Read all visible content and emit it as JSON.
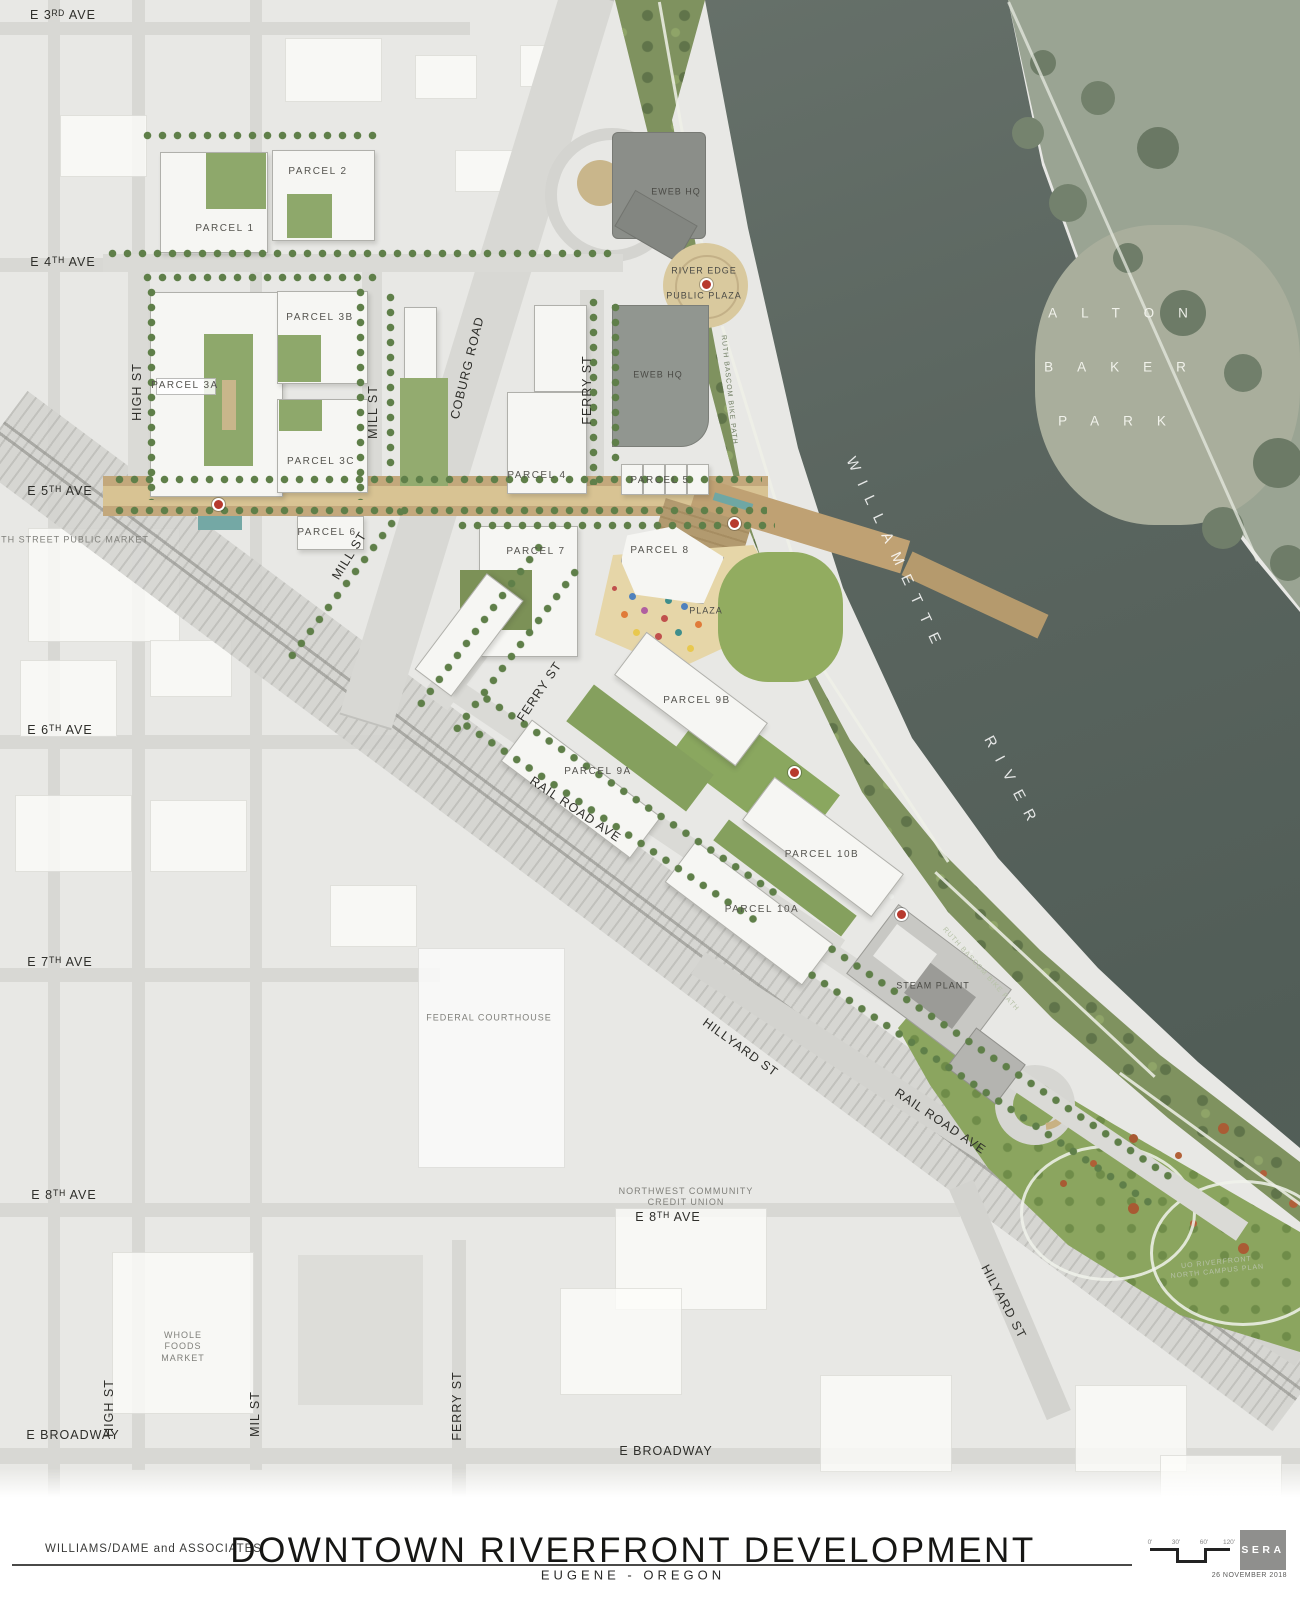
{
  "title_block": {
    "client": "WILLIAMS/DAME and ASSOCIATES",
    "title": "DOWNTOWN RIVERFRONT DEVELOPMENT",
    "subtitle": "EUGENE - OREGON",
    "firm_logo": "SERA",
    "date": "26 NOVEMBER 2018",
    "scale_ticks": [
      "0'",
      "30'",
      "60'",
      "120'"
    ]
  },
  "map": {
    "street_labels": [
      {
        "t": "E 3ᴿᴰ AVE",
        "x": 63,
        "y": 16,
        "r": 0
      },
      {
        "t": "E 4ᵀᴴ AVE",
        "x": 63,
        "y": 263,
        "r": 0
      },
      {
        "t": "E 5ᵀᴴ AVE",
        "x": 60,
        "y": 492,
        "r": 0
      },
      {
        "t": "E 6ᵀᴴ AVE",
        "x": 60,
        "y": 731,
        "r": 0
      },
      {
        "t": "E 7ᵀᴴ AVE",
        "x": 60,
        "y": 963,
        "r": 0
      },
      {
        "t": "E 8ᵀᴴ AVE",
        "x": 64,
        "y": 1196,
        "r": 0
      },
      {
        "t": "E 8ᵀᴴ AVE",
        "x": 668,
        "y": 1218,
        "r": 0
      },
      {
        "t": "E BROADWAY",
        "x": 73,
        "y": 1436,
        "r": 0
      },
      {
        "t": "E BROADWAY",
        "x": 666,
        "y": 1452,
        "r": 0
      },
      {
        "t": "HIGH ST",
        "x": 138,
        "y": 392,
        "r": -90
      },
      {
        "t": "HIGH ST",
        "x": 110,
        "y": 1408,
        "r": -90
      },
      {
        "t": "MILL ST",
        "x": 374,
        "y": 412,
        "r": -90
      },
      {
        "t": "MILL ST",
        "x": 350,
        "y": 556,
        "r": -58
      },
      {
        "t": "MIL ST",
        "x": 256,
        "y": 1414,
        "r": -90
      },
      {
        "t": "COBURG ROAD",
        "x": 468,
        "y": 368,
        "r": -76
      },
      {
        "t": "FERRY ST",
        "x": 588,
        "y": 390,
        "r": -90
      },
      {
        "t": "FERRY ST",
        "x": 540,
        "y": 692,
        "r": -56
      },
      {
        "t": "FERRY ST",
        "x": 458,
        "y": 1406,
        "r": -90
      },
      {
        "t": "RAIL ROAD AVE",
        "x": 575,
        "y": 810,
        "r": 34
      },
      {
        "t": "RAIL ROAD AVE",
        "x": 940,
        "y": 1122,
        "r": 34
      },
      {
        "t": "HILLYARD ST",
        "x": 740,
        "y": 1048,
        "r": 36
      },
      {
        "t": "HILYARD ST",
        "x": 1003,
        "y": 1302,
        "r": 62
      }
    ],
    "parcel_labels": [
      {
        "t": "PARCEL 1",
        "x": 225,
        "y": 229,
        "r": 0
      },
      {
        "t": "PARCEL 2",
        "x": 318,
        "y": 172,
        "r": 0
      },
      {
        "t": "PARCEL 3A",
        "x": 185,
        "y": 386,
        "r": 0
      },
      {
        "t": "PARCEL 3B",
        "x": 320,
        "y": 318,
        "r": 0
      },
      {
        "t": "PARCEL 3C",
        "x": 321,
        "y": 462,
        "r": 0
      },
      {
        "t": "PARCEL 4",
        "x": 537,
        "y": 476,
        "r": 0
      },
      {
        "t": "PARCEL 5",
        "x": 660,
        "y": 481,
        "r": 0
      },
      {
        "t": "PARCEL 6",
        "x": 327,
        "y": 533,
        "r": 0
      },
      {
        "t": "PARCEL 7",
        "x": 536,
        "y": 552,
        "r": 0
      },
      {
        "t": "PARCEL 8",
        "x": 660,
        "y": 551,
        "r": 0
      },
      {
        "t": "PARCEL 9A",
        "x": 598,
        "y": 772,
        "r": 0
      },
      {
        "t": "PARCEL 9B",
        "x": 697,
        "y": 701,
        "r": 0
      },
      {
        "t": "PARCEL 10A",
        "x": 762,
        "y": 910,
        "r": 0
      },
      {
        "t": "PARCEL 10B",
        "x": 822,
        "y": 855,
        "r": 0
      }
    ],
    "place_labels": [
      {
        "t": "EWEB HQ",
        "x": 676,
        "y": 192,
        "r": 0,
        "d": 1
      },
      {
        "t": "EWEB HQ",
        "x": 658,
        "y": 375,
        "r": 0,
        "d": 1
      },
      {
        "t": "RIVER EDGE",
        "x": 704,
        "y": 271,
        "r": 0,
        "d": 1
      },
      {
        "t": "PUBLIC PLAZA",
        "x": 704,
        "y": 296,
        "r": 0,
        "d": 1
      },
      {
        "t": "PLAZA",
        "x": 706,
        "y": 611,
        "r": 0,
        "d": 1
      },
      {
        "t": "STEAM PLANT",
        "x": 933,
        "y": 986,
        "r": 0,
        "d": 1
      },
      {
        "t": "FEDERAL COURTHOUSE",
        "x": 489,
        "y": 1018,
        "r": 0
      },
      {
        "t": "NORTHWEST COMMUNITY\nCREDIT UNION",
        "x": 686,
        "y": 1197,
        "r": 0
      },
      {
        "t": "WHOLE\nFOODS\nMARKET",
        "x": 183,
        "y": 1347,
        "r": 0
      },
      {
        "t": "5TH STREET PUBLIC MARKET",
        "x": 72,
        "y": 540,
        "r": 0
      }
    ],
    "water_labels": [
      {
        "t": "WILLAMETTE",
        "x": 895,
        "y": 556,
        "r": 65
      },
      {
        "t": "RIVER",
        "x": 1012,
        "y": 784,
        "r": 62
      }
    ],
    "park_labels": [
      {
        "t": "ALTON",
        "x": 1130,
        "y": 314,
        "r": 0
      },
      {
        "t": "BAKER",
        "x": 1127,
        "y": 368,
        "r": 0
      },
      {
        "t": "PARK",
        "x": 1124,
        "y": 422,
        "r": 0
      }
    ],
    "path_labels": [
      {
        "t": "RUTH BASCOM BIKE PATH",
        "x": 728,
        "y": 390,
        "r": 84
      },
      {
        "t": "RUTH BASCOM BIKE PATH",
        "x": 980,
        "y": 970,
        "r": 48,
        "lt": 1
      },
      {
        "t": "UO RIVERFRONT\nNORTH CAMPUS PLAN",
        "x": 1217,
        "y": 1268,
        "r": -6,
        "lt": 1
      }
    ]
  }
}
